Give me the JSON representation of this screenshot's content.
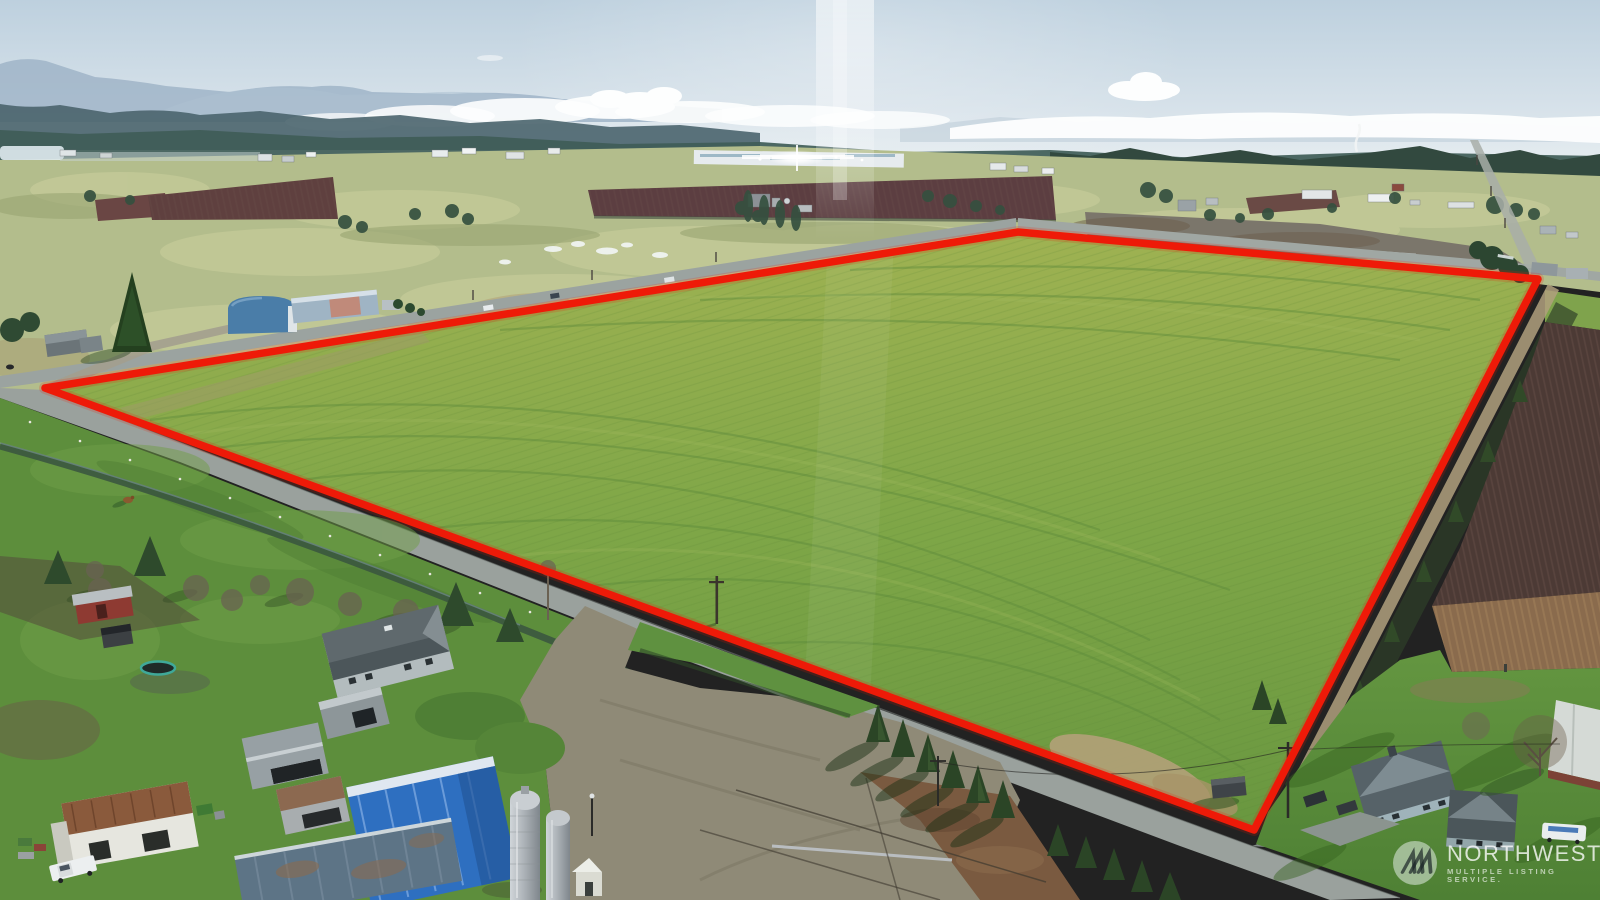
{
  "watermark": {
    "title": "NORTHWEST",
    "subtitle": "MULTIPLE LISTING SERVICE.",
    "logo_icon": "nwmls-three-peaks-icon"
  },
  "palette": {
    "boundary_red": "#ee1a08",
    "sky_top": "#bdd0de",
    "sky_horizon": "#f4f7f7",
    "field_green_light": "#9fb252",
    "field_green_dark": "#699740",
    "pasture_green": "#5d8e3c",
    "far_field_tan": "#b3bd8c",
    "berry_maroon": "#5c3e41",
    "forest_teal": "#44606b",
    "road_gray": "#9ba3a0",
    "gravel_tan": "#8f8a77",
    "barn_blue": "#2e6fc0",
    "dirt_brown": "#7a5a40",
    "watermark_white": "#ffffff"
  }
}
